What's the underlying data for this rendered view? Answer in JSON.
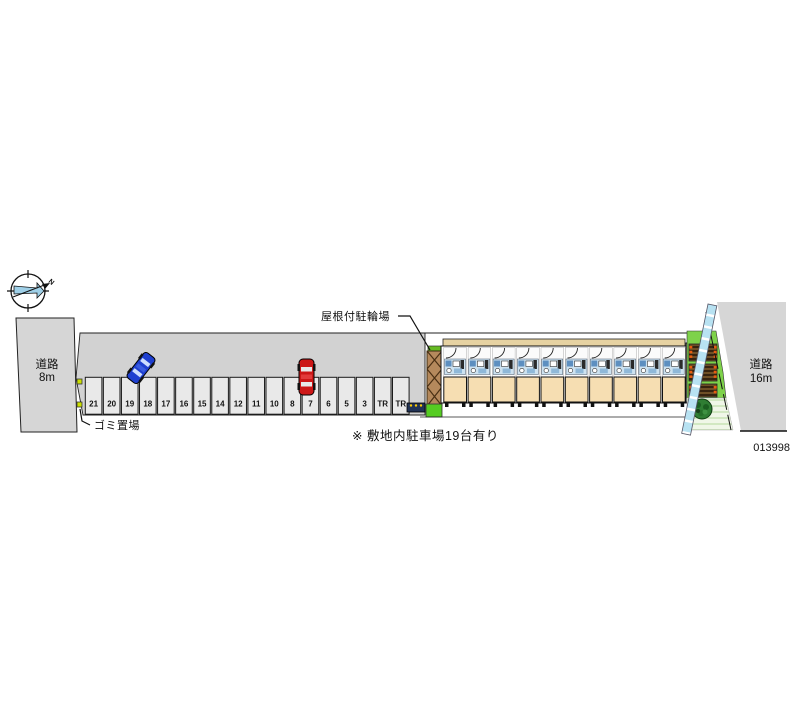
{
  "site_plan": {
    "plan_id": "013998",
    "note": "※ 敷地内駐車場19台有り",
    "compass": {
      "north_label": "N"
    },
    "roads": {
      "left": {
        "name": "道路",
        "width": "8m"
      },
      "right": {
        "name": "道路",
        "width": "16m"
      }
    },
    "annotations": {
      "garbage_area": "ゴミ置場",
      "covered_bicycle_parking": "屋根付駐輪場"
    },
    "parking": {
      "stall_labels": [
        "21",
        "20",
        "19",
        "18",
        "17",
        "16",
        "15",
        "14",
        "12",
        "11",
        "10",
        "8",
        "7",
        "6",
        "5",
        "3",
        "TR",
        "TR"
      ]
    },
    "building": {
      "unit_count": 10
    },
    "colors": {
      "road_gray": "#d6d6d6",
      "driveway_gray": "#d2d2d2",
      "stall_fill": "#e9e9e9",
      "room_beige": "#f6deb2",
      "eave_tan": "#e6d2a2",
      "shed_brown": "#b5895c",
      "grass_green": "#7ed24a",
      "sidewalk_blue": "#b8e2f2",
      "car_blue": "#1e3fd0",
      "car_red": "#cc1717",
      "marker_chartreuse": "#cce000",
      "rack_orange": "#e85c10",
      "tree_green": "#2f7d33"
    }
  }
}
